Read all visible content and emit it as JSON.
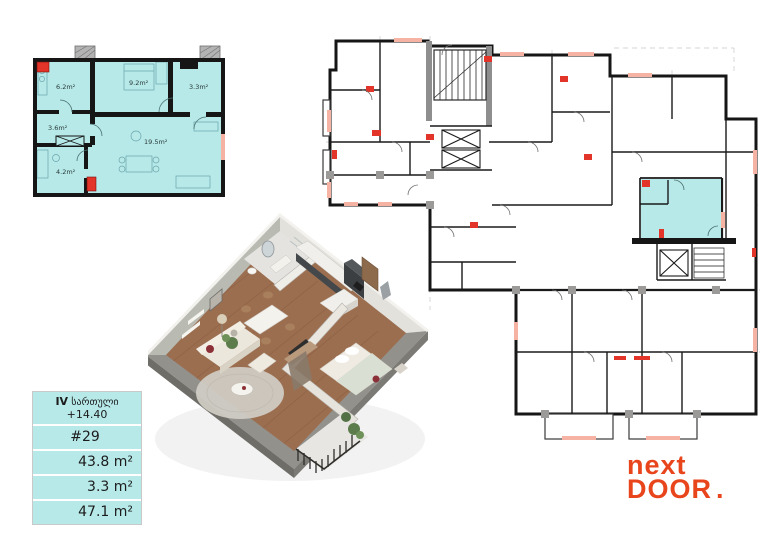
{
  "unit_plan": {
    "rooms": [
      {
        "name": "kitchen",
        "area": "6.2m²"
      },
      {
        "name": "bedroom",
        "area": "9.2m²"
      },
      {
        "name": "balcony",
        "area": "3.3m²"
      },
      {
        "name": "hallway",
        "area": "3.6m²"
      },
      {
        "name": "bathroom",
        "area": "4.2m²"
      },
      {
        "name": "living-room",
        "area": "19.5m²"
      }
    ]
  },
  "building_plan": {
    "highlighted_unit": "#29",
    "highlight_color": "#b7e9e9"
  },
  "info_box": {
    "floor_roman": "IV",
    "floor_word": "სართული",
    "elevation": "+14.40",
    "unit_number": "#29",
    "rows": [
      {
        "label": "apartment-area",
        "value": "43.8 m²"
      },
      {
        "label": "balcony-area",
        "value": "3.3 m²"
      },
      {
        "label": "total-area",
        "value": "47.1 m²"
      }
    ]
  },
  "logo": {
    "line1": "next",
    "line2": "DOOR",
    "dot": "."
  },
  "colors": {
    "highlight_cyan": "#b7e9e9",
    "marker_red": "#e23428",
    "window_salmon": "#f6b3a4",
    "wall_black": "#161616",
    "logo_red": "#e8451c"
  }
}
